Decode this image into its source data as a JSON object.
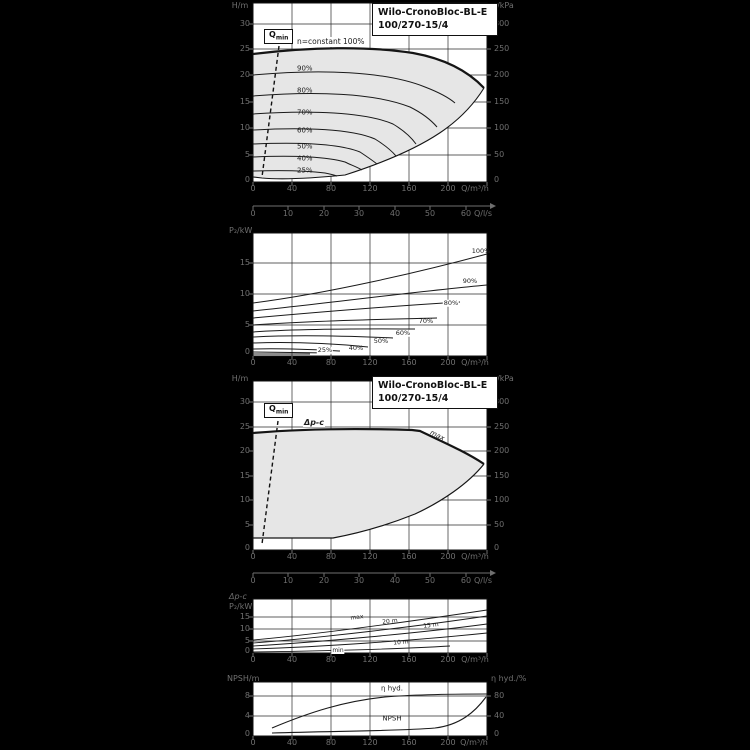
{
  "colors": {
    "background": "#000000",
    "panel": "#ffffff",
    "field_fill": "#e6e6e6",
    "line": "#1a1a1a",
    "muted_text": "#6f6f6f"
  },
  "title_box": {
    "line1": "Wilo-CronoBloc-BL-E",
    "line2": "100/270-15/4"
  },
  "qmin": {
    "base": "Q",
    "sub": "min"
  },
  "chart1": {
    "y_left_unit": "H/m",
    "y_left_ticks": [
      "30",
      "25",
      "20",
      "15",
      "10",
      "5",
      "0"
    ],
    "y_right_unit": "p/kPa",
    "y_right_ticks": [
      "300",
      "250",
      "200",
      "150",
      "100",
      "50",
      "0"
    ],
    "x_ticks": [
      "0",
      "40",
      "80",
      "120",
      "160",
      "200"
    ],
    "x_unit": "Q/m³/h",
    "n_constant_label": "n=constant 100%",
    "speed_labels": [
      "90%",
      "80%",
      "70%",
      "60%",
      "50%",
      "40%",
      "25%"
    ]
  },
  "lps_axis": {
    "ticks": [
      "0",
      "10",
      "20",
      "30",
      "40",
      "50",
      "60"
    ],
    "unit": "Q/l/s"
  },
  "chart2": {
    "y_unit": "P₂/kW",
    "y_ticks": [
      "15",
      "10",
      "5",
      "0"
    ],
    "x_ticks": [
      "0",
      "40",
      "80",
      "120",
      "160",
      "200"
    ],
    "x_unit": "Q/m³/h",
    "curve_labels": [
      "100%",
      "90%",
      "80%",
      "70%",
      "60%",
      "50%",
      "40%",
      "25%"
    ]
  },
  "chart3": {
    "mode_label": "Δp-c",
    "max_label": "max",
    "y_left_unit": "H/m",
    "y_left_ticks": [
      "30",
      "25",
      "20",
      "15",
      "10",
      "5",
      "0"
    ],
    "y_right_unit": "p/kPa",
    "y_right_ticks": [
      "300",
      "250",
      "200",
      "150",
      "100",
      "50",
      "0"
    ],
    "x_ticks": [
      "0",
      "40",
      "80",
      "120",
      "160",
      "200"
    ],
    "x_unit": "Q/m³/h"
  },
  "chart4": {
    "mode_label": "Δp-c",
    "y_unit": "P₂/kW",
    "y_ticks": [
      "15",
      "10",
      "5",
      "0"
    ],
    "x_ticks": [
      "0",
      "40",
      "80",
      "120",
      "160",
      "200"
    ],
    "x_unit": "Q/m³/h",
    "curve_labels": [
      "max",
      "20 m",
      "15 m",
      "10 m",
      "min"
    ]
  },
  "chart5": {
    "y_left_unit": "NPSH/m",
    "y_left_ticks": [
      "8",
      "4",
      "0"
    ],
    "y_right_unit": "η hyd./%",
    "y_right_ticks": [
      "80",
      "40",
      "0"
    ],
    "x_ticks": [
      "0",
      "40",
      "80",
      "120",
      "160",
      "200"
    ],
    "x_unit": "Q/m³/h",
    "eta_label": "η hyd.",
    "npsh_label": "NPSH"
  },
  "chart_data": [
    {
      "type": "line",
      "title": "Wilo-CronoBloc-BL-E 100/270-15/4",
      "xlabel": "Q/m³/h",
      "x2label": "Q/l/s",
      "ylabel": "H/m",
      "y2label": "p/kPa",
      "xlim": [
        0,
        240
      ],
      "x2lim": [
        0,
        65
      ],
      "ylim": [
        0,
        32
      ],
      "grid": true,
      "annotations": [
        "Qmin",
        "n=constant 100%"
      ],
      "series": [
        {
          "name": "100%",
          "x": [
            0,
            60,
            120,
            180,
            236
          ],
          "y": [
            24.8,
            25.3,
            24.4,
            21.5,
            17.8
          ]
        },
        {
          "name": "90%",
          "x": [
            0,
            60,
            120,
            207
          ],
          "y": [
            20.3,
            20.8,
            19.8,
            15.0
          ]
        },
        {
          "name": "80%",
          "x": [
            0,
            60,
            120,
            189
          ],
          "y": [
            16.3,
            16.7,
            15.6,
            10.4
          ]
        },
        {
          "name": "70%",
          "x": [
            0,
            50,
            100,
            167
          ],
          "y": [
            12.9,
            13.2,
            12.3,
            7.2
          ]
        },
        {
          "name": "60%",
          "x": [
            0,
            40,
            90,
            147
          ],
          "y": [
            9.9,
            10.1,
            9.2,
            4.9
          ]
        },
        {
          "name": "50%",
          "x": [
            0,
            40,
            80,
            127
          ],
          "y": [
            7.2,
            7.3,
            6.6,
            3.4
          ]
        },
        {
          "name": "40%",
          "x": [
            0,
            30,
            70,
            112
          ],
          "y": [
            4.7,
            4.8,
            4.2,
            2.3
          ]
        },
        {
          "name": "25%",
          "x": [
            0,
            30,
            60,
            86
          ],
          "y": [
            2.1,
            2.1,
            1.8,
            1.1
          ]
        }
      ]
    },
    {
      "type": "line",
      "xlabel": "Q/m³/h",
      "ylabel": "P₂/kW",
      "xlim": [
        0,
        240
      ],
      "ylim": [
        0,
        17.5
      ],
      "grid": true,
      "series": [
        {
          "name": "100%",
          "x": [
            0,
            120,
            240
          ],
          "y": [
            8.5,
            12.5,
            16.5
          ]
        },
        {
          "name": "90%",
          "x": [
            0,
            120,
            230
          ],
          "y": [
            6.8,
            9.3,
            11.5
          ]
        },
        {
          "name": "80%",
          "x": [
            0,
            110,
            212
          ],
          "y": [
            5.2,
            6.9,
            8.5
          ]
        },
        {
          "name": "70%",
          "x": [
            0,
            100,
            189
          ],
          "y": [
            4.0,
            5.0,
            6.0
          ]
        },
        {
          "name": "60%",
          "x": [
            0,
            90,
            166
          ],
          "y": [
            3.0,
            3.6,
            4.2
          ]
        },
        {
          "name": "50%",
          "x": [
            0,
            80,
            144
          ],
          "y": [
            2.2,
            2.5,
            2.9
          ]
        },
        {
          "name": "40%",
          "x": [
            0,
            70,
            118
          ],
          "y": [
            1.6,
            1.7,
            1.9
          ]
        },
        {
          "name": "25%",
          "x": [
            0,
            50,
            89
          ],
          "y": [
            0.8,
            0.9,
            1.0
          ]
        }
      ]
    },
    {
      "type": "area",
      "title": "Wilo-CronoBloc-BL-E 100/270-15/4 (Δp-c operating field)",
      "xlabel": "Q/m³/h",
      "x2label": "Q/l/s",
      "ylabel": "H/m",
      "y2label": "p/kPa",
      "xlim": [
        0,
        240
      ],
      "ylim": [
        0,
        32
      ],
      "grid": true,
      "annotations": [
        "Qmin",
        "Δp-c",
        "max"
      ],
      "series": [
        {
          "name": "upper limit (max)",
          "x": [
            0,
            80,
            160,
            200,
            236
          ],
          "y": [
            24.2,
            24.6,
            24.6,
            22.0,
            17.8
          ]
        },
        {
          "name": "lower limit",
          "x": [
            0,
            82,
            140,
            190,
            220,
            236
          ],
          "y": [
            2.3,
            2.3,
            5.0,
            9.5,
            13.5,
            17.8
          ]
        }
      ]
    },
    {
      "type": "line",
      "xlabel": "Q/m³/h",
      "ylabel": "P₂/kW",
      "xlim": [
        0,
        240
      ],
      "ylim": [
        0,
        22
      ],
      "grid": true,
      "annotations": [
        "Δp-c"
      ],
      "series": [
        {
          "name": "max",
          "x": [
            0,
            120,
            240
          ],
          "y": [
            5.4,
            10.5,
            17.5
          ]
        },
        {
          "name": "20 m",
          "x": [
            0,
            120,
            240
          ],
          "y": [
            4.2,
            8.6,
            15.4
          ]
        },
        {
          "name": "15 m",
          "x": [
            0,
            120,
            240
          ],
          "y": [
            2.9,
            6.2,
            12.1
          ]
        },
        {
          "name": "10 m",
          "x": [
            0,
            120,
            240
          ],
          "y": [
            1.7,
            3.8,
            7.9
          ]
        },
        {
          "name": "min",
          "x": [
            0,
            120,
            200
          ],
          "y": [
            0.4,
            0.9,
            1.5
          ]
        }
      ]
    },
    {
      "type": "line",
      "xlabel": "Q/m³/h",
      "ylabel": "NPSH/m",
      "y2label": "η hyd./%",
      "xlim": [
        0,
        240
      ],
      "ylim": [
        0,
        10
      ],
      "y2lim": [
        0,
        100
      ],
      "grid": true,
      "series": [
        {
          "name": "η hyd.",
          "axis": "right",
          "x": [
            20,
            60,
            100,
            160,
            236
          ],
          "y": [
            16,
            55,
            74,
            83,
            84
          ]
        },
        {
          "name": "NPSH",
          "axis": "left",
          "x": [
            20,
            100,
            160,
            200,
            225,
            238
          ],
          "y": [
            0.6,
            0.9,
            1.4,
            2.6,
            5.2,
            8.0
          ]
        }
      ]
    }
  ]
}
